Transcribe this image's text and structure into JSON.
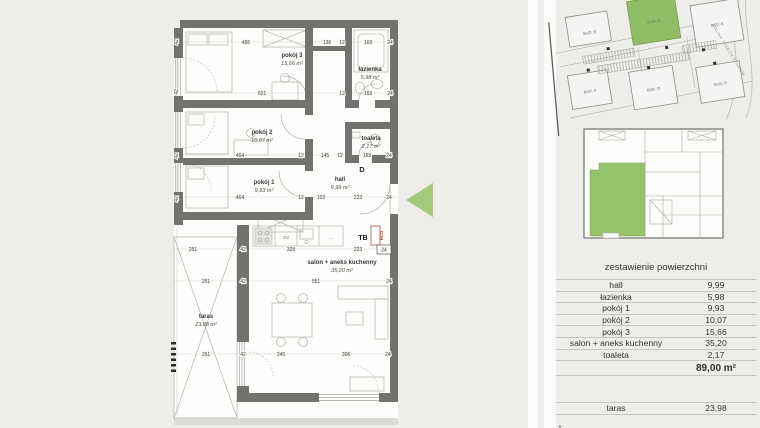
{
  "plan": {
    "apartment_letter": "D",
    "tb_label": "TB",
    "rco_label": "RCO",
    "boxed_dim": "24",
    "kitchen": {
      "zm": "ZM",
      "dots": "···"
    },
    "rooms": [
      {
        "name": "pokój 3",
        "area": "15,66 m²",
        "x": 292,
        "y": 57
      },
      {
        "name": "łazienka",
        "area": "5,98 m²",
        "x": 370,
        "y": 71
      },
      {
        "name": "pokój 2",
        "area": "10,07 m²",
        "x": 262,
        "y": 134
      },
      {
        "name": "toaleta",
        "area": "2,17 m²",
        "x": 371,
        "y": 140
      },
      {
        "name": "pokój 1",
        "area": "9,93 m²",
        "x": 264,
        "y": 184
      },
      {
        "name": "hall",
        "area": "9,99 m²",
        "x": 340,
        "y": 181
      },
      {
        "name": "salon + aneks kuchenny",
        "area": "35,20 m²",
        "x": 342,
        "y": 264
      },
      {
        "name": "taras",
        "area": "23,98 m²",
        "x": 206,
        "y": 318
      }
    ],
    "dimensions": [
      {
        "t": "485",
        "x": 246,
        "y": 44
      },
      {
        "t": "136",
        "x": 327,
        "y": 44
      },
      {
        "t": "12",
        "x": 342,
        "y": 44
      },
      {
        "t": "169",
        "x": 368,
        "y": 44
      },
      {
        "t": "24",
        "x": 390,
        "y": 44
      },
      {
        "t": "621",
        "x": 262,
        "y": 95
      },
      {
        "t": "12",
        "x": 342,
        "y": 95
      },
      {
        "t": "169",
        "x": 368,
        "y": 95
      },
      {
        "t": "24",
        "x": 390,
        "y": 95
      },
      {
        "t": "464",
        "x": 240,
        "y": 157
      },
      {
        "t": "12",
        "x": 301,
        "y": 157
      },
      {
        "t": "145",
        "x": 325,
        "y": 157
      },
      {
        "t": "12",
        "x": 340,
        "y": 157
      },
      {
        "t": "169",
        "x": 367,
        "y": 157
      },
      {
        "t": "24",
        "x": 389,
        "y": 157
      },
      {
        "t": "464",
        "x": 240,
        "y": 199
      },
      {
        "t": "12",
        "x": 301,
        "y": 199
      },
      {
        "t": "103",
        "x": 321,
        "y": 199
      },
      {
        "t": "223",
        "x": 358,
        "y": 199
      },
      {
        "t": "24",
        "x": 389,
        "y": 199
      },
      {
        "t": "251",
        "x": 193,
        "y": 251
      },
      {
        "t": "42",
        "x": 243,
        "y": 251
      },
      {
        "t": "328",
        "x": 291,
        "y": 251
      },
      {
        "t": "223",
        "x": 358,
        "y": 251
      },
      {
        "t": "251",
        "x": 206,
        "y": 283
      },
      {
        "t": "42",
        "x": 243,
        "y": 283
      },
      {
        "t": "551",
        "x": 316,
        "y": 283
      },
      {
        "t": "24",
        "x": 389,
        "y": 283
      },
      {
        "t": "251",
        "x": 206,
        "y": 356
      },
      {
        "t": "42",
        "x": 243,
        "y": 356
      },
      {
        "t": "245",
        "x": 281,
        "y": 356
      },
      {
        "t": "306",
        "x": 346,
        "y": 356
      },
      {
        "t": "24",
        "x": 388,
        "y": 356
      },
      {
        "t": "42",
        "x": 178,
        "y": 42,
        "r": 1
      },
      {
        "t": "42",
        "x": 178,
        "y": 92,
        "r": 1
      },
      {
        "t": "42",
        "x": 178,
        "y": 156,
        "r": 1
      },
      {
        "t": "42",
        "x": 178,
        "y": 199,
        "r": 1
      }
    ]
  },
  "site_plan": {
    "street_label": "DOLINA TRZECH STAWÓW",
    "buildings": [
      {
        "label": "BUD. E",
        "x": 595,
        "y": 24
      },
      {
        "label": "BUD. C",
        "x": 660,
        "y": 23
      },
      {
        "label": "BUD. A",
        "x": 722,
        "y": 36
      },
      {
        "label": "BUD. F",
        "x": 586,
        "y": 82
      },
      {
        "label": "BUD. D",
        "x": 649,
        "y": 90
      },
      {
        "label": "BUD. B",
        "x": 716,
        "y": 95
      }
    ]
  },
  "table": {
    "title": "zestawienie powierzchni",
    "rows": [
      {
        "label": "hall",
        "value": "9,99"
      },
      {
        "label": "łazienka",
        "value": "5,98"
      },
      {
        "label": "pokój 1",
        "value": "9,93"
      },
      {
        "label": "pokój 2",
        "value": "10,07"
      },
      {
        "label": "pokój 3",
        "value": "15,66"
      },
      {
        "label": "salon + aneks kuchenny",
        "value": "35,20"
      },
      {
        "label": "toaleta",
        "value": "2,17"
      }
    ],
    "total_value": "89,00 m²",
    "taras_label": "taras",
    "taras_value": "23,98",
    "footnote": "*"
  },
  "colors": {
    "accent_green": "#9cc874",
    "site_green": "#8fbe66",
    "wall_gray": "#73726c",
    "rco_red": "#b03a2e"
  }
}
